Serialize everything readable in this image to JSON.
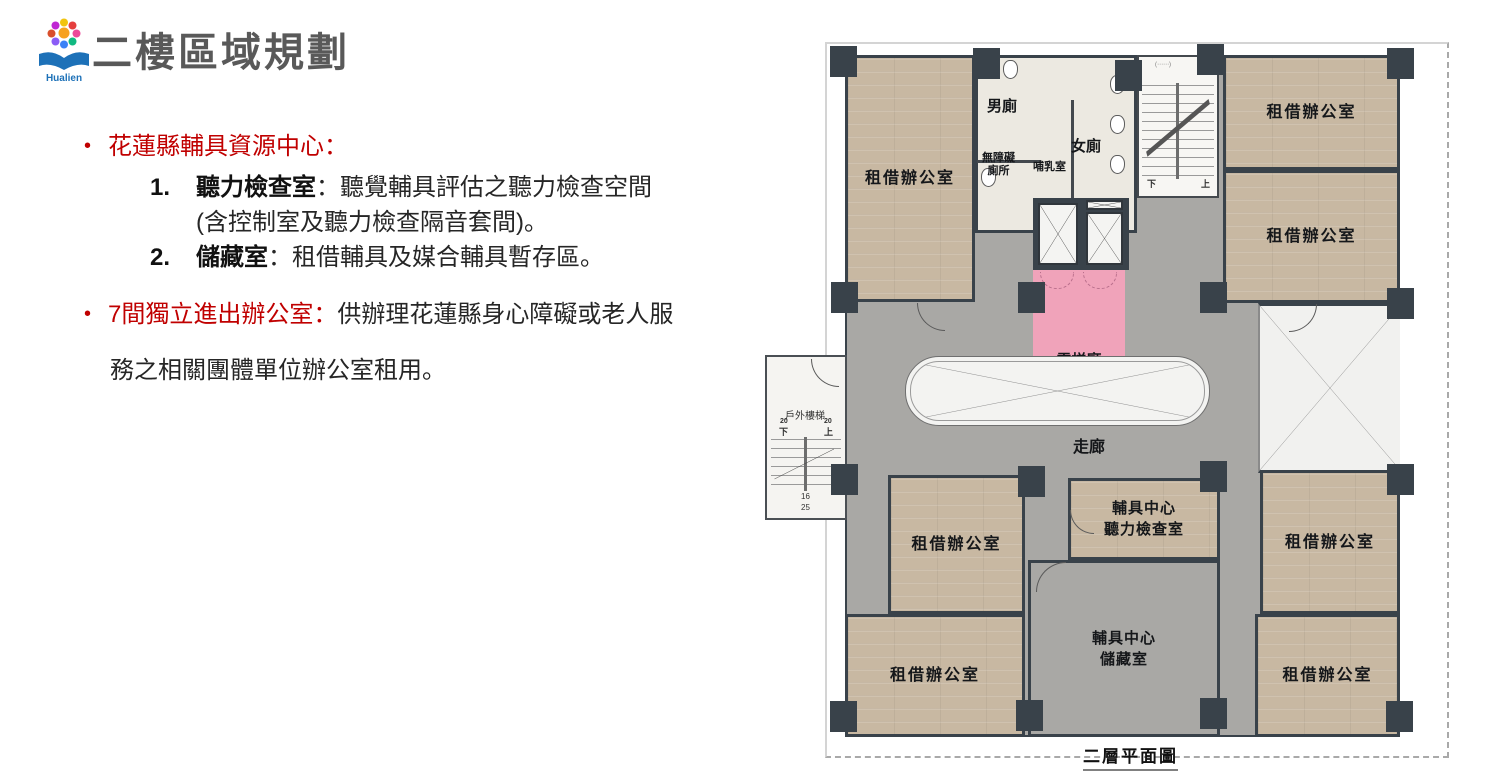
{
  "title": "二樓區域規劃",
  "logo": {
    "text": "Hualien"
  },
  "bullets": {
    "b1": {
      "heading": "花蓮縣輔具資源中心：",
      "item1_num": "1.",
      "item1_bold": "聽力檢查室",
      "item1_rest": "：聽覺輔具評估之聽力檢查空間",
      "item1_line2": "(含控制室及聽力檢查隔音套間)。",
      "item2_num": "2.",
      "item2_bold": "儲藏室",
      "item2_rest": "：租借輔具及媒合輔具暫存區。"
    },
    "b2": {
      "heading": "7間獨立進出辦公室：",
      "line1": "供辦理花蓮縣身心障礙或老人服",
      "line2": "務之相關團體單位辦公室租用。"
    }
  },
  "colors": {
    "accent_red": "#C00000",
    "title_gray": "#595959",
    "elevator_pink": "#F0A3BA",
    "wood_floor": "#C8B8A2",
    "corridor_gray": "#A9A8A5",
    "wall_dark": "#39424A"
  },
  "floorplan": {
    "caption": "二層平面圖",
    "labels": {
      "office": "租借辦公室",
      "mens": "男廁",
      "womens": "女廁",
      "accessible1": "無障礙",
      "accessible2": "廁所",
      "nursing": "哺乳室",
      "elevator1": "電梯廳",
      "elevator2": "Pink",
      "corridor": "走廊",
      "hearing1": "輔具中心",
      "hearing2": "聽力檢查室",
      "storage1": "輔具中心",
      "storage2": "儲藏室",
      "outdoor_stairs": "戶外樓梯",
      "down": "下",
      "up": "上",
      "n20a": "20",
      "n20b": "20",
      "n16": "16",
      "n25": "25"
    }
  }
}
